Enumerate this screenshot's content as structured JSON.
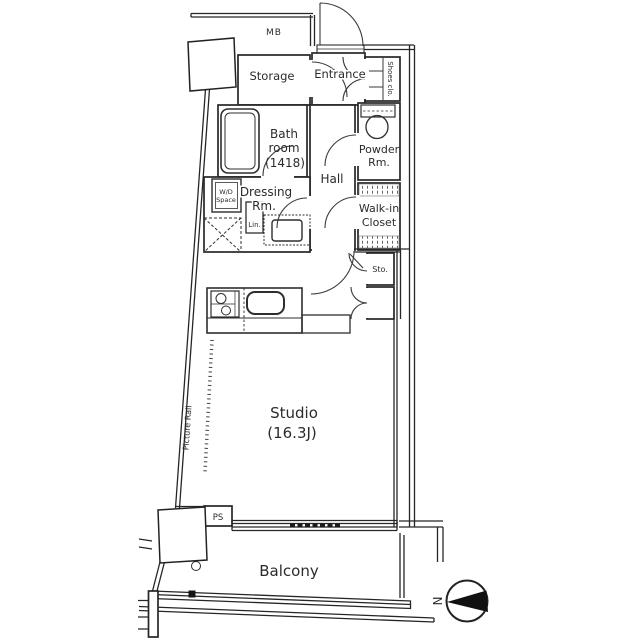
{
  "plan": {
    "type": "apartment-floor-plan",
    "labels": {
      "mb": "MB",
      "storage": "Storage",
      "entrance": "Entrance",
      "shoes_closet": "Shoes clo.",
      "bathroom_l1": "Bath",
      "bathroom_l2": "room",
      "bathroom_l3": "(1418)",
      "powder_l1": "Powder",
      "powder_l2": "Rm.",
      "hall": "Hall",
      "walkin_l1": "Walk-in",
      "walkin_l2": "Closet",
      "dressing_l1": "Dressing",
      "dressing_l2": "Rm.",
      "wd_l1": "W/D",
      "wd_l2": "Space",
      "linen": "Lin.",
      "small_storage": "Sto.",
      "studio_l1": "Studio",
      "studio_l2": "(16.3J)",
      "balcony": "Balcony",
      "ps": "PS",
      "picture_rail": "Picture Rail",
      "compass_north": "N"
    },
    "colors": {
      "background": "#ffffff",
      "line": "#262626",
      "text": "#2b2b2b",
      "compass_wedge": "#111111"
    }
  }
}
